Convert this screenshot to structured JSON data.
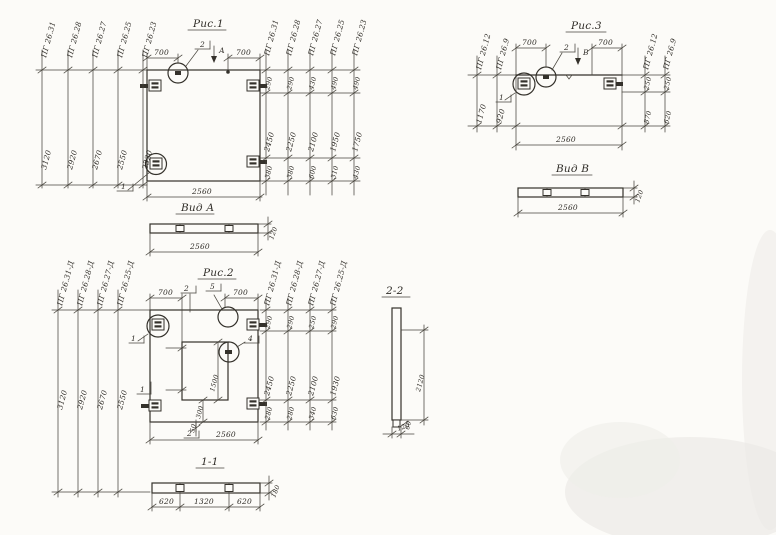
{
  "page": {
    "background": "#fcfbf8",
    "ink": "#34312b"
  },
  "fig1": {
    "title": "Рис.1",
    "left_cols": [
      {
        "label": "ПГ 26.31",
        "value": "3120"
      },
      {
        "label": "ПГ 26.28",
        "value": "2920"
      },
      {
        "label": "ПГ 26.27",
        "value": "2670"
      },
      {
        "label": "ПГ 26.25",
        "value": "2550"
      },
      {
        "label": "ПГ 26.23",
        "value": "2320"
      }
    ],
    "right_cols": [
      {
        "label": "ПГ 26.31",
        "top": "290",
        "mid": "2450",
        "bottom": "380"
      },
      {
        "label": "ПГ 26.28",
        "top": "290",
        "mid": "2250",
        "bottom": "380"
      },
      {
        "label": "ПГ 26.27",
        "top": "430",
        "mid": "2100",
        "bottom": "600"
      },
      {
        "label": "ПГ 26.25",
        "top": "490",
        "mid": "1950",
        "bottom": "310"
      },
      {
        "label": "ПГ 26.23",
        "top": "490",
        "mid": "1750",
        "bottom": "430"
      }
    ],
    "top_dim_left": "700",
    "top_dim_right": "700",
    "bottom_dim": "2560",
    "detail_marker": "2",
    "view_marker": "А",
    "item_marker": "1"
  },
  "view_a": {
    "title": "Вид А",
    "length": "2560",
    "thickness": "120"
  },
  "fig2": {
    "title": "Рис.2",
    "left_cols": [
      {
        "label": "ПГ 26.31-Д",
        "value": "3120"
      },
      {
        "label": "ПГ 26.28-Д",
        "value": "2920"
      },
      {
        "label": "ПГ 26.27-Д",
        "value": "2670"
      },
      {
        "label": "ПГ 26.25-Д",
        "value": "2550"
      }
    ],
    "right_cols": [
      {
        "label": "ПГ 26.31-Д",
        "top": "290",
        "mid": "2450",
        "bottom": "280"
      },
      {
        "label": "ПГ 26.28-Д",
        "top": "290",
        "mid": "2250",
        "bottom": "280"
      },
      {
        "label": "ПГ 26.27-Д",
        "top": "250",
        "mid": "2100",
        "bottom": "340"
      },
      {
        "label": "ПГ 26.25-Д",
        "top": "290",
        "mid": "1930",
        "bottom": "630"
      }
    ],
    "top_dim_left": "700",
    "top_dim_right": "700",
    "bottom_dim": "2560",
    "section_marker": "2",
    "detail_marker_top": "5",
    "detail_marker_side": "4",
    "item_marker": "1",
    "section_marker_side": "1",
    "opening_height": "1500",
    "opening_foot": "300",
    "opening_gap": "50"
  },
  "section_1_1": {
    "title": "1-1",
    "segments": [
      "620",
      "1320",
      "620"
    ],
    "thickness": "180"
  },
  "fig3": {
    "title": "Рис.3",
    "left_cols": [
      {
        "label": "ПГ 26.12",
        "value": "1170"
      },
      {
        "label": "ПГ 26.9",
        "value": "920"
      }
    ],
    "right_cols": [
      {
        "label": "ПГ 26.12",
        "top": "250",
        "bottom": "870"
      },
      {
        "label": "ПГ 26.9",
        "top": "250",
        "bottom": "620"
      }
    ],
    "top_dim_left": "700",
    "top_dim_right": "700",
    "bottom_dim": "2560",
    "detail_marker": "2",
    "view_marker": "В",
    "item_marker": "1"
  },
  "view_b": {
    "title": "Вид В",
    "length": "2560",
    "thickness": "120"
  },
  "section_2_2": {
    "title": "2-2",
    "height": "2120",
    "toe": "60",
    "width": "120"
  }
}
